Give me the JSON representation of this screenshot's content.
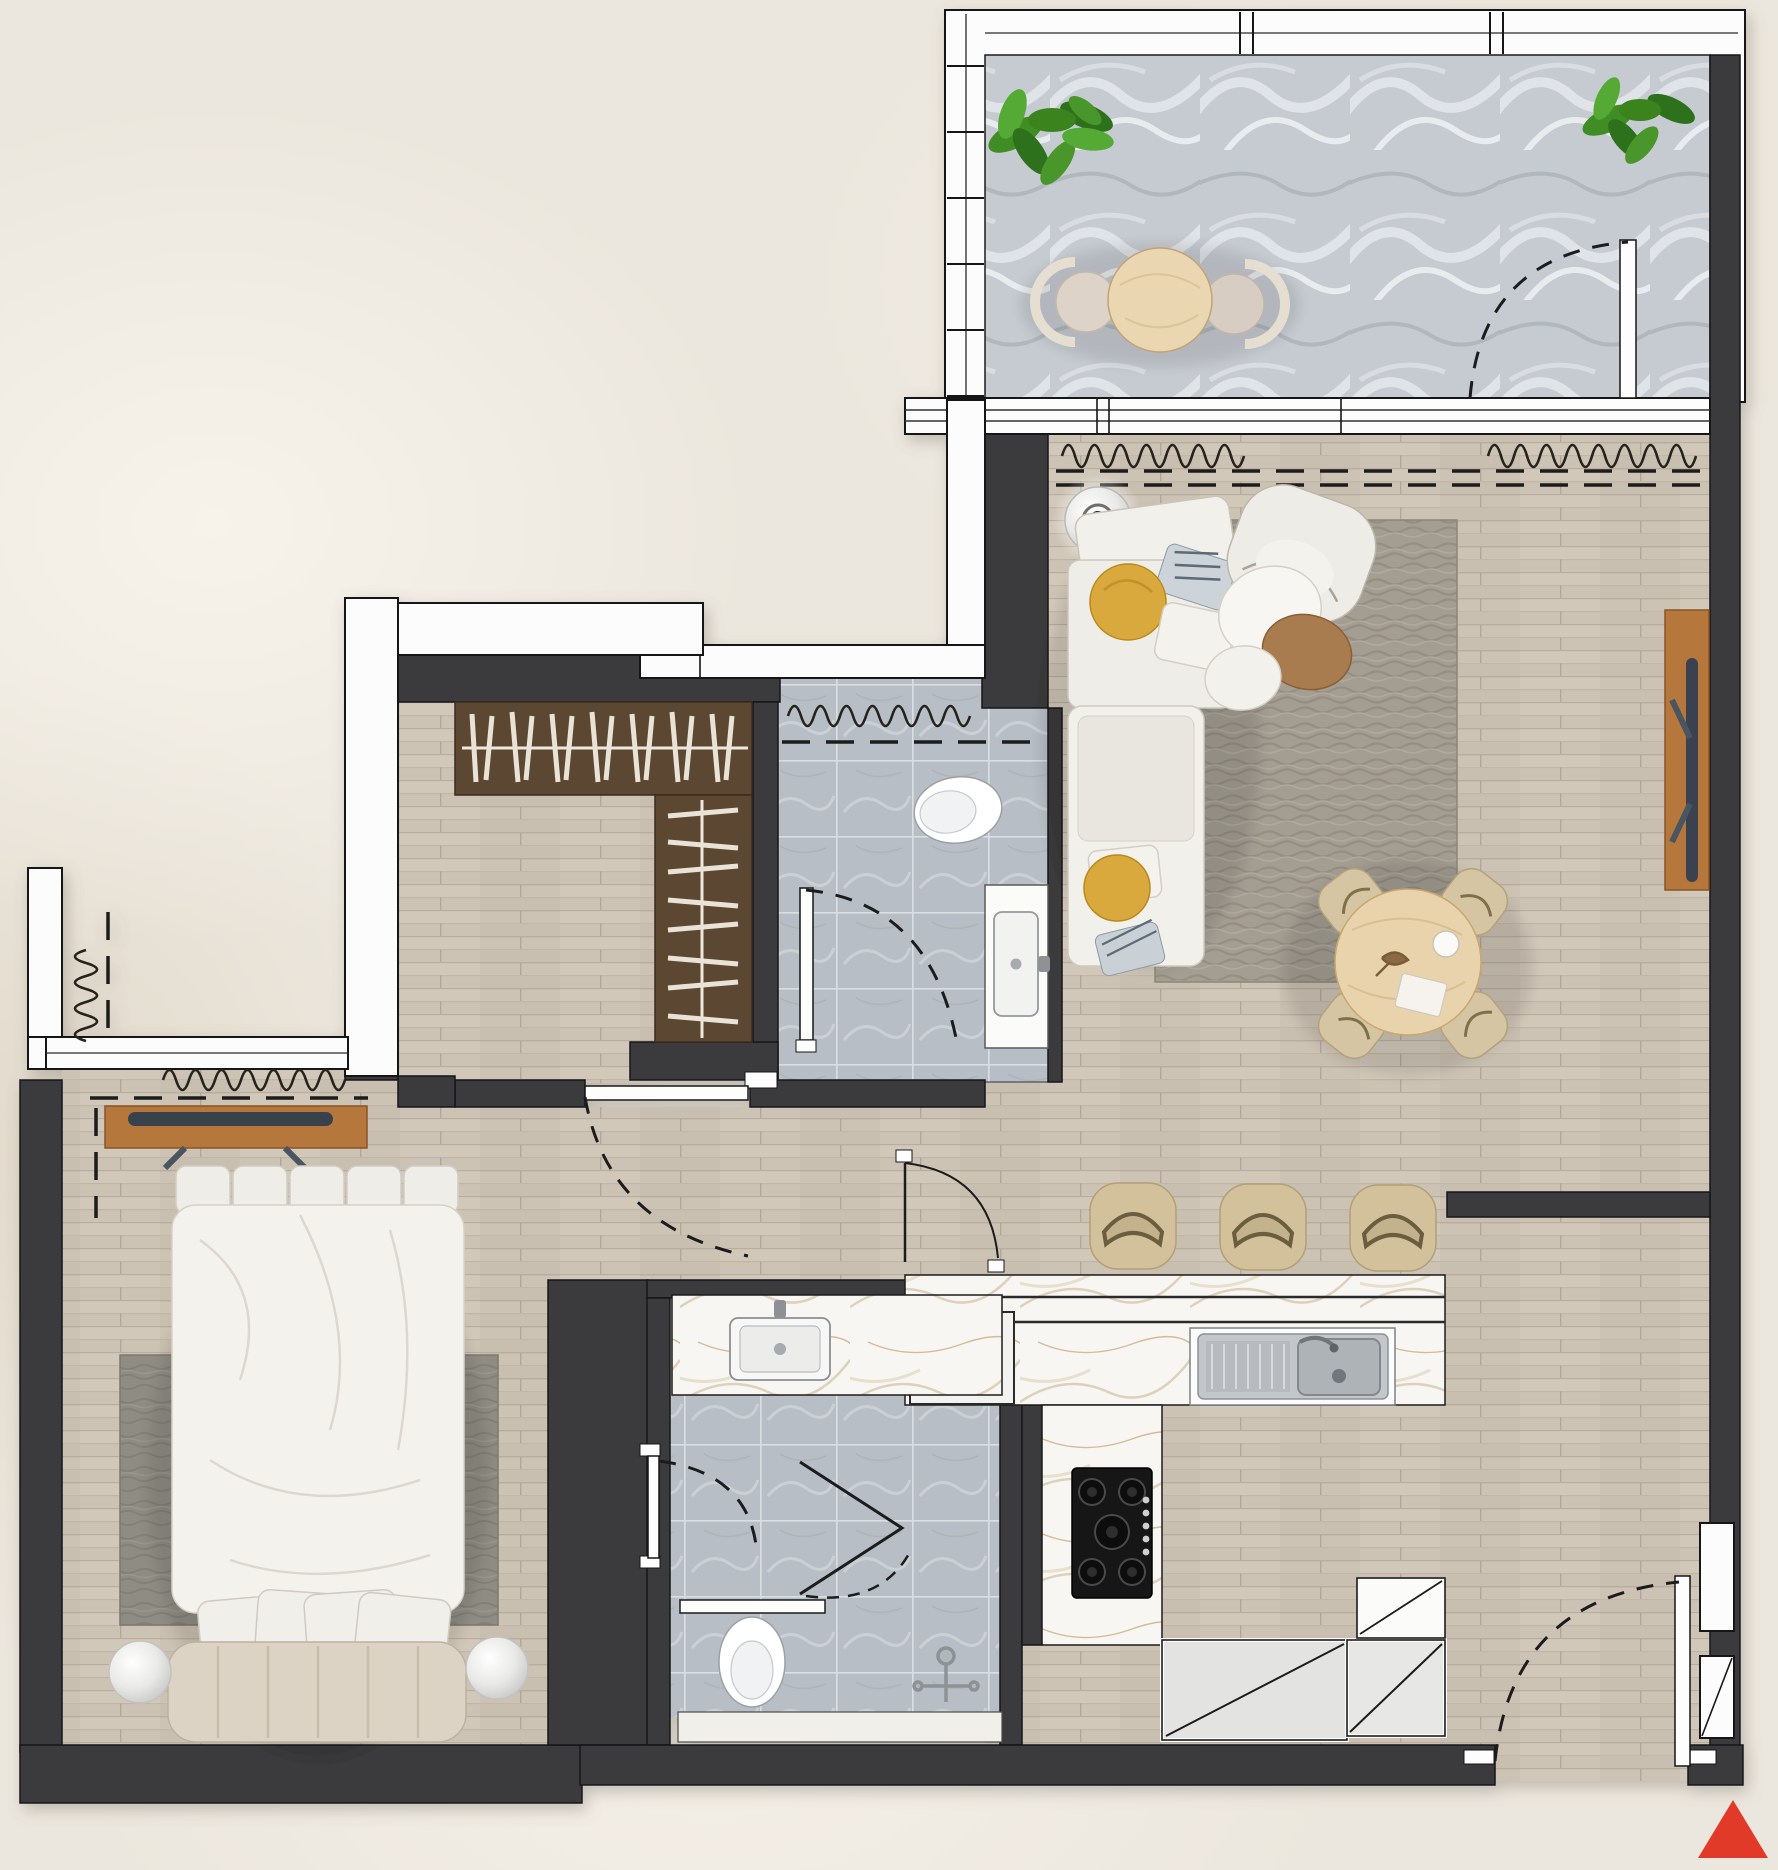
{
  "meta": {
    "kind": "residential floor plan, top-down render",
    "text_labels_visible": "none"
  },
  "colors": {
    "background": "#ece7de",
    "wall": "#3b3b3d",
    "window_white": "#fcfcfc",
    "floor_wood": "#cdc3b5",
    "balcony_marble": "#c6cbd1",
    "bath_tile": "#b7bec5",
    "counter_marble": "#f8f6f2",
    "closet_wood": "#5c4732",
    "console_wood": "#b5773b",
    "sofa_white": "#f0eee9",
    "rug_gray": "#a39d92",
    "bedroom_rug": "#8f8c83",
    "seat_tan": "#d6c5a2",
    "table_wood": "#e8d3ac",
    "plant_green": "#3f8d28",
    "stove_black": "#161616",
    "steel": "#b9bdc1",
    "accent_red": "#e23a28"
  },
  "rooms": [
    {
      "id": "balcony",
      "floor": "gray marble",
      "furniture": [
        "potted-plant",
        "potted-plant",
        "round-cafe-table",
        "two-chairs"
      ]
    },
    {
      "id": "living-dining",
      "floor": "light wood plank",
      "furniture": [
        "l-shaped-sofa",
        "floor-lamp",
        "area-rug",
        "armchair",
        "coffee-tables",
        "round-dining-table",
        "four-dining-chairs",
        "tv-console"
      ]
    },
    {
      "id": "kitchen",
      "floor": "wood + marble counters",
      "furniture": [
        "three-bar-stools",
        "counter-with-sink",
        "washing-machine",
        "gas-hob-5-burner",
        "corner-cabinets"
      ]
    },
    {
      "id": "entry-hall",
      "floor": "light wood plank",
      "furniture": [
        "entry-door",
        "wall-niches"
      ]
    },
    {
      "id": "dressing-area",
      "floor": "light wood plank",
      "furniture": [
        "l-shaped-open-wardrobe"
      ]
    },
    {
      "id": "powder-room",
      "floor": "gray tile",
      "furniture": [
        "toilet",
        "vanity-sink"
      ]
    },
    {
      "id": "bedroom",
      "floor": "light wood plank",
      "furniture": [
        "double-bed",
        "two-round-nightstands",
        "bedroom-rug",
        "tv-console",
        "window-curtains"
      ]
    },
    {
      "id": "ensuite-bathroom",
      "floor": "gray tile",
      "furniture": [
        "vanity-sink",
        "toilet",
        "shower-with-folding-glass-door",
        "marble-bench"
      ]
    }
  ],
  "symbols": {
    "door_swing": "dashed quarter-circle arc",
    "curtain": "wavy sine line",
    "sliding_window": "thin white framed band",
    "marker_bottom_right": "red-triangle"
  }
}
